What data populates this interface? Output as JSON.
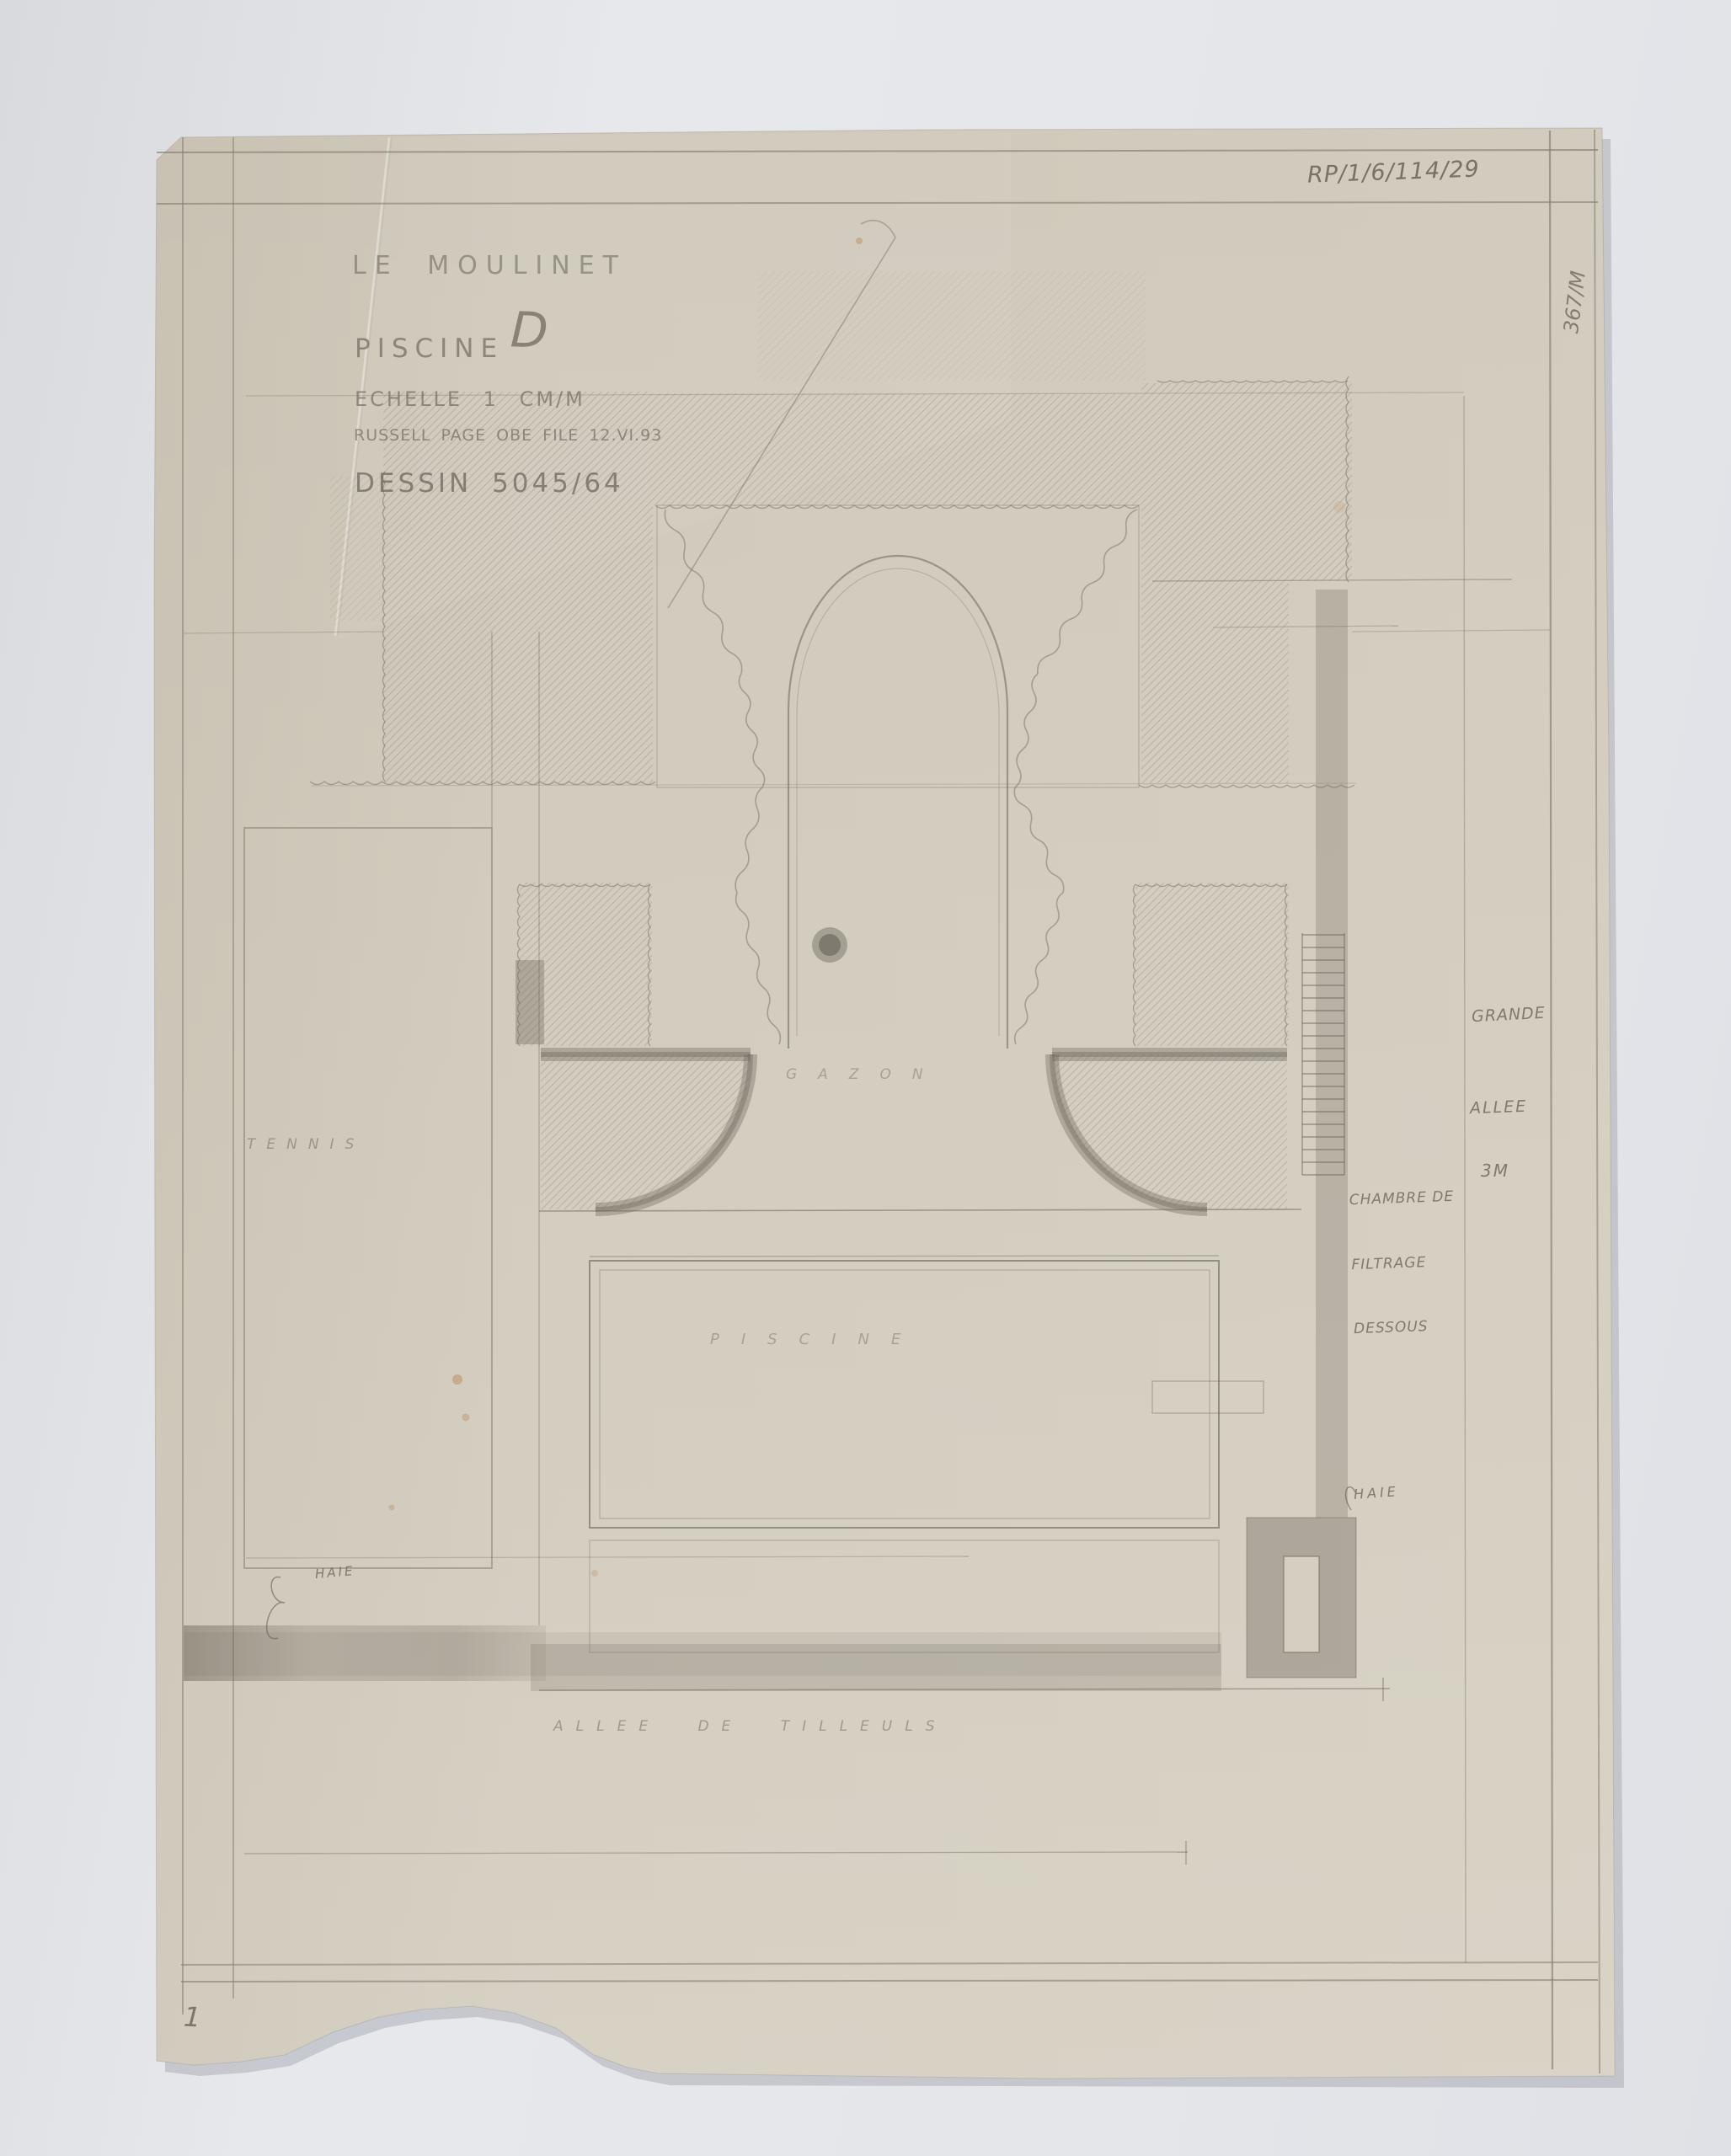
{
  "sheet": {
    "archive_reference": "RP/1/6/114/29",
    "edge_number": "367/M",
    "page_number": "1",
    "title_block": {
      "project": "LE MOULINET",
      "drawing_name": "PISCINE",
      "drawing_letter": "D",
      "scale": "ECHELLE 1 CM/M",
      "attribution": "RUSSELL PAGE OBE FILE 12.VI.93",
      "drawing_number": "DESSIN 5045/64"
    },
    "plan_labels": {
      "tennis": "TENNIS",
      "lawn": "GAZON",
      "pool": "PISCINE",
      "filter_room": [
        "CHAMBRE DE",
        "FILTRAGE",
        "DESSOUS"
      ],
      "grande": "GRANDE",
      "allee": "ALLEE",
      "allee_width": "3M",
      "hedge_right": "HAIE",
      "hedge_left": "HAIE",
      "lime_avenue": "ALLEE DE TILLEULS"
    },
    "colors": {
      "background": "#e4e6ea",
      "paper": "#d2ccbe",
      "pencil": "#847e71",
      "pencil_dark": "#6e685e",
      "stain": "#bc8a55"
    }
  }
}
